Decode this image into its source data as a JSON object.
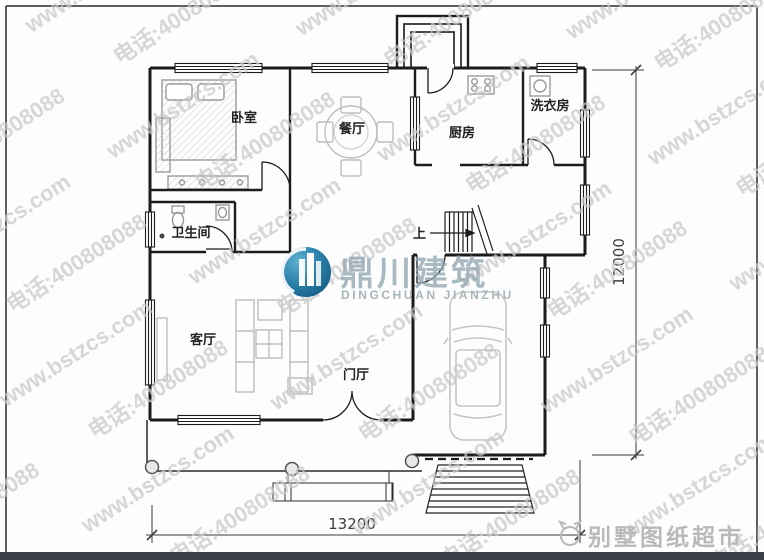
{
  "watermark": {
    "line1": "www.bstzcs.com",
    "line2": "电话:4008080889"
  },
  "logo": {
    "name": "鼎川建筑",
    "romanized": "DINGCHUAN JIANZHU"
  },
  "footer_brand": {
    "name": "别墅图纸超市"
  },
  "rooms": {
    "bedroom": "卧室",
    "dining": "餐厅",
    "kitchen": "厨房",
    "laundry": "洗衣房",
    "bathroom": "卫生间",
    "living": "客厅",
    "foyer": "门厅",
    "stair_up": "上"
  },
  "dimensions": {
    "width_mm": "13200",
    "depth_mm": "12000"
  },
  "colors": {
    "wall": "#1c1c1c",
    "watermark_gray": "#c9c9c9",
    "logo_teal": "#2b7fa8",
    "footer_bar": "#3a3f46"
  }
}
